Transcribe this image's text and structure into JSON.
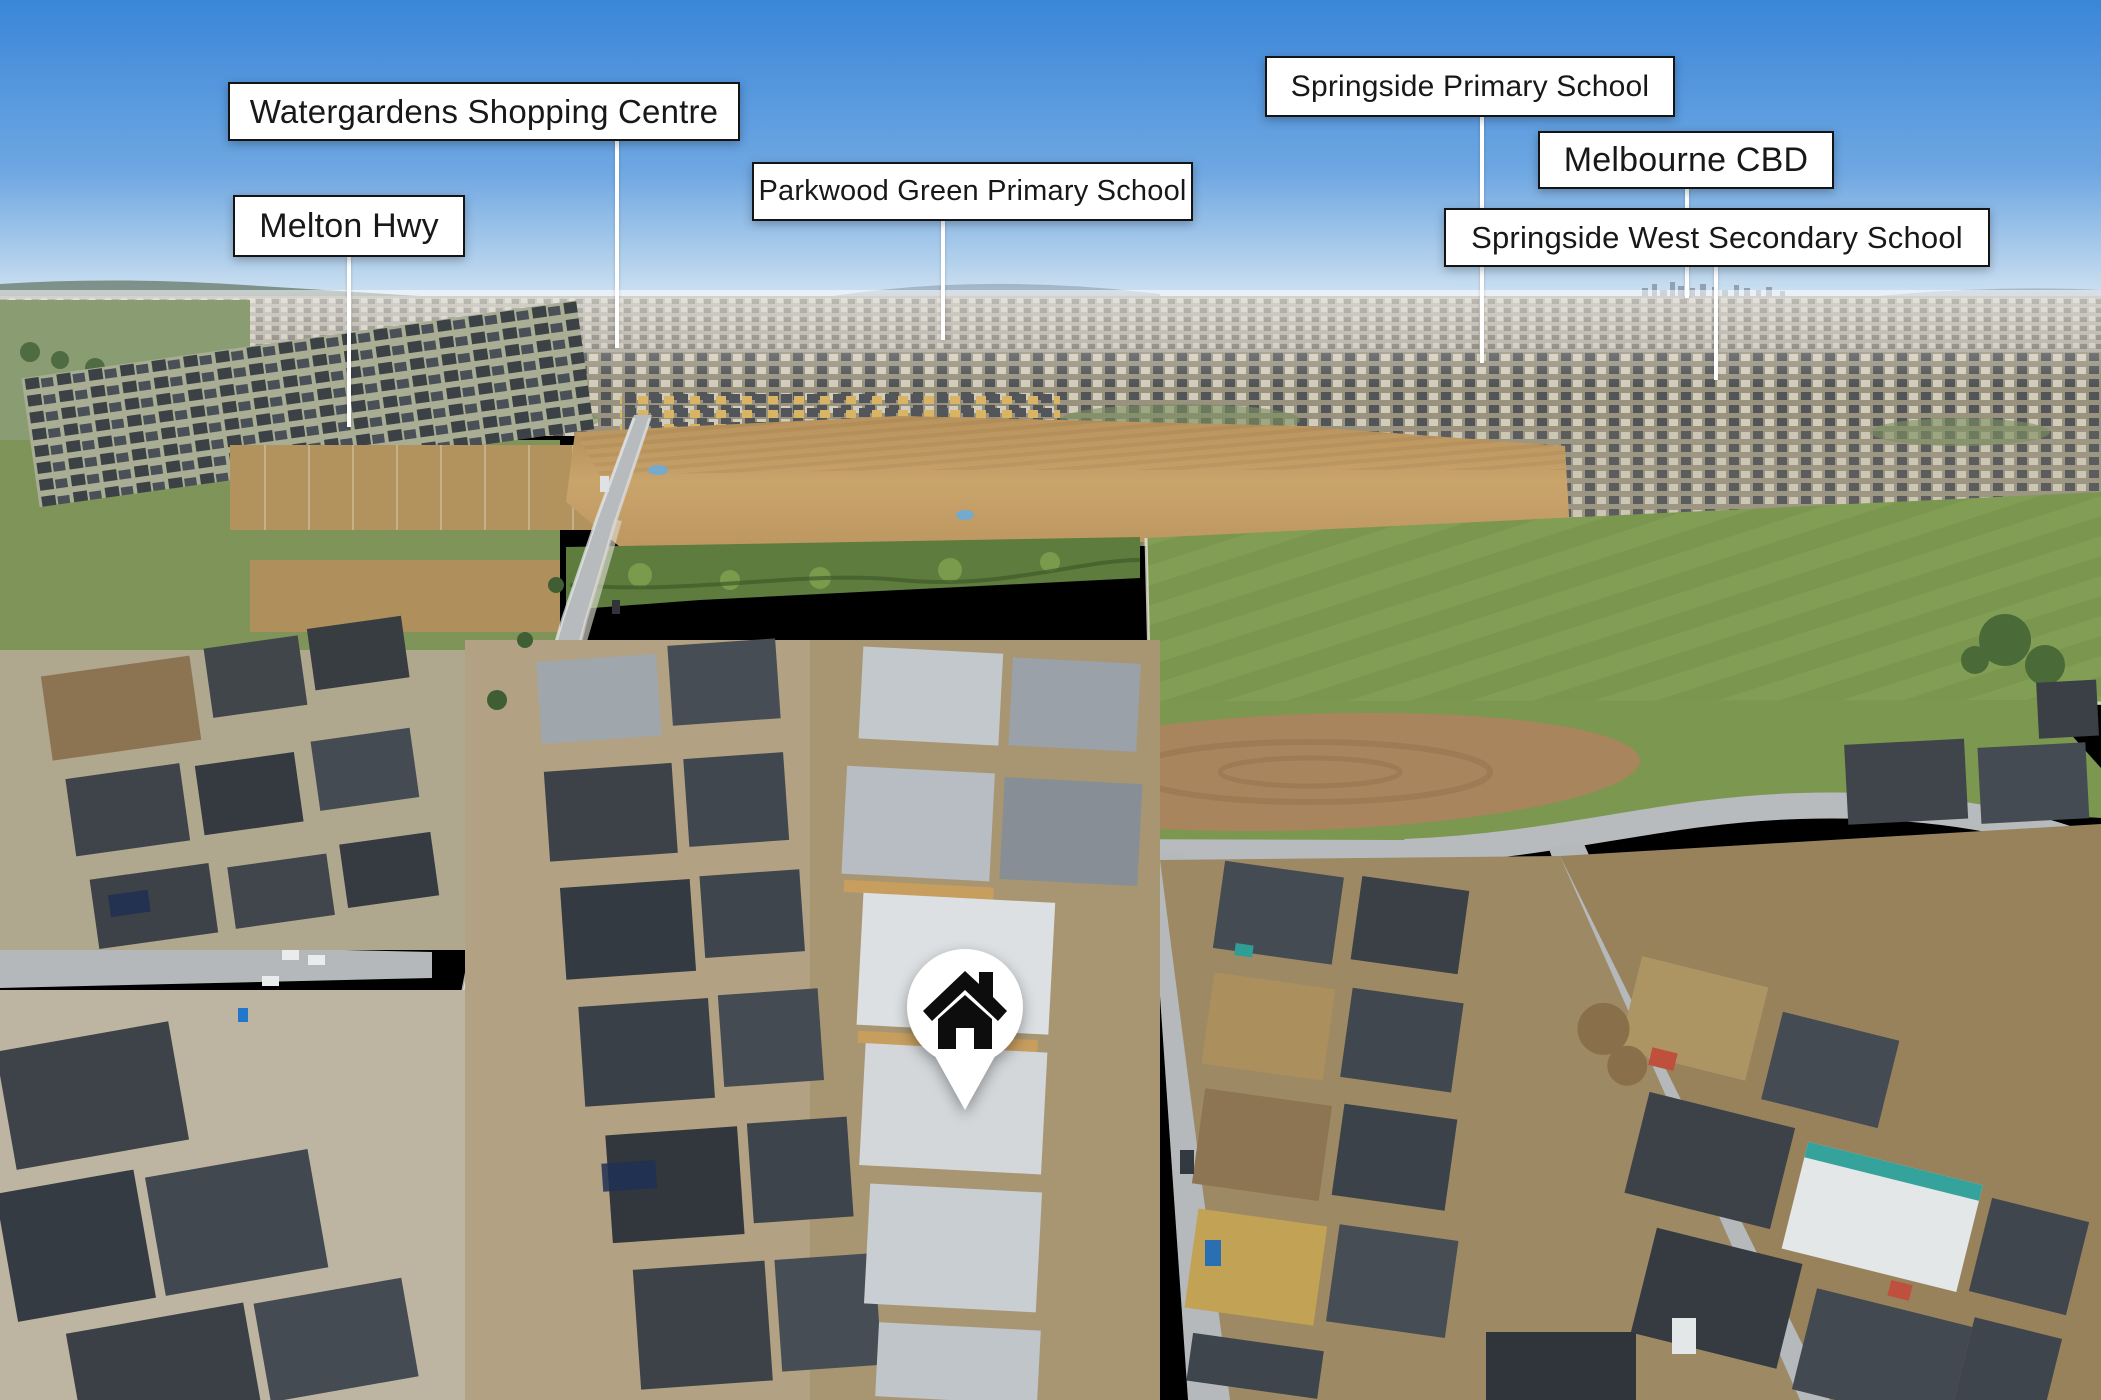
{
  "scene": {
    "type": "annotated-aerial-photo",
    "description": "Aerial drone photograph of a new suburban housing estate with six location callout labels and a house location pin"
  },
  "labels": [
    {
      "text": "Watergardens Shopping Centre"
    },
    {
      "text": "Melton Hwy"
    },
    {
      "text": "Parkwood Green Primary School"
    },
    {
      "text": "Springside Primary School"
    },
    {
      "text": "Melbourne CBD"
    },
    {
      "text": "Springside West Secondary School"
    }
  ],
  "marker": {
    "icon": "house-icon"
  },
  "palette": {
    "sky_top": "#3a86d8",
    "sky_horizon": "#dceaf5",
    "callout_bg": "#ffffff",
    "callout_border": "#141414",
    "callout_text": "#181818",
    "pointer_line": "#ffffff",
    "dirt_field": "#c9a46b",
    "paddock_green": "#7e9a52",
    "roof_charcoal": "#3c4248",
    "road_gray": "#b7bbbd",
    "pin_fill": "#ffffff",
    "pin_icon": "#0d0d0d"
  }
}
